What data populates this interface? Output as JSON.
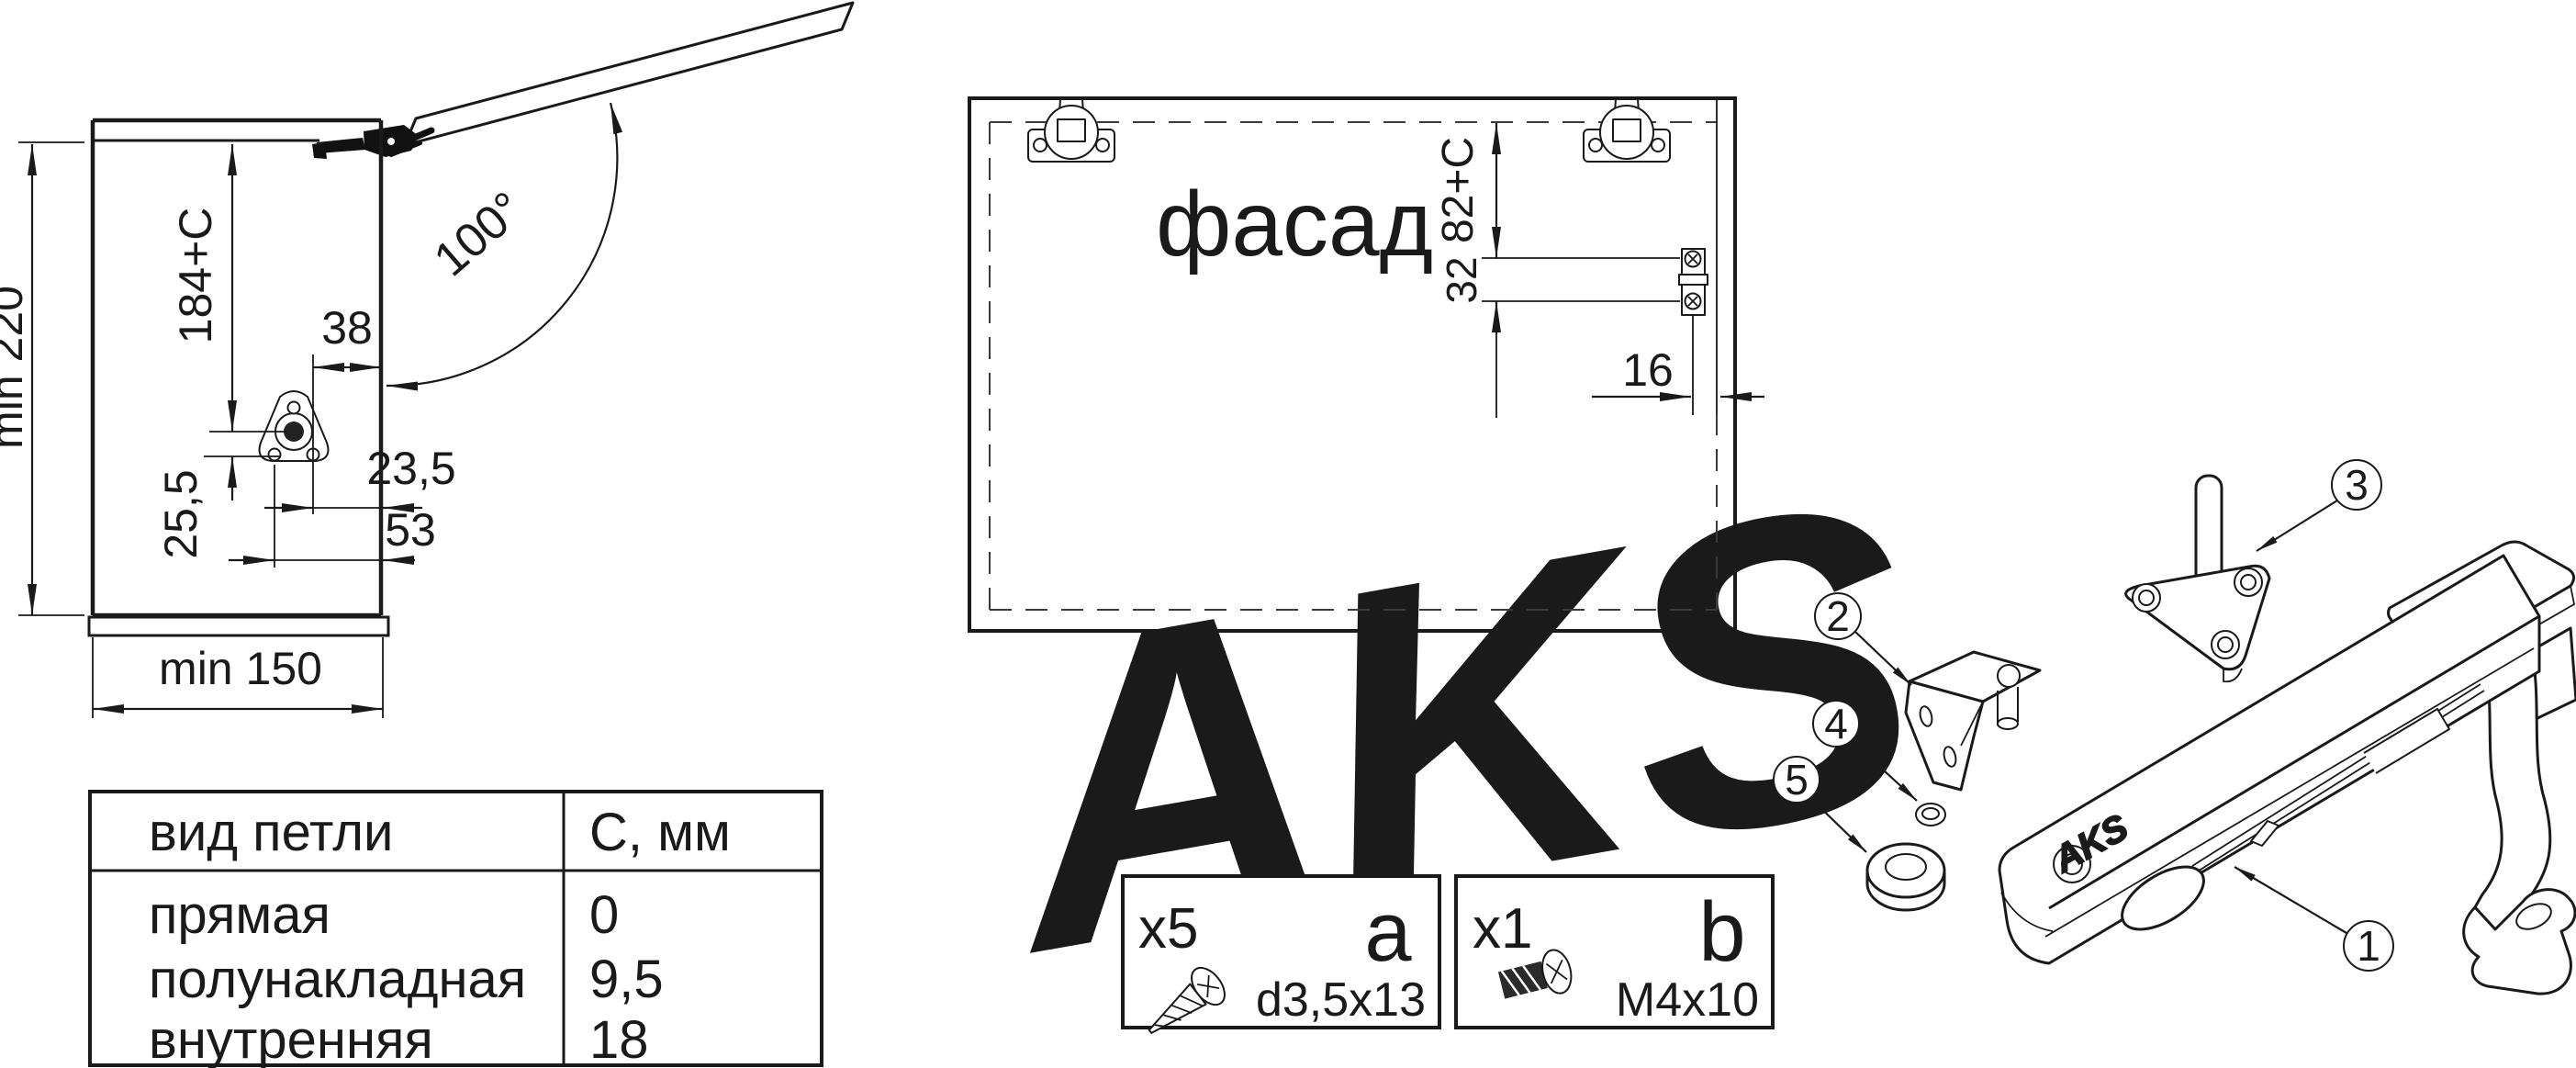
{
  "side_view": {
    "min_height": "min 220",
    "arm_height": "184+C",
    "angle": "100°",
    "dim_38": "38",
    "dim_23_5": "23,5",
    "dim_25_5": "25,5",
    "dim_53": "53",
    "min_depth": "min 150"
  },
  "hinge_table": {
    "col_type": "вид петли",
    "col_c": "С, мм",
    "rows": [
      {
        "type": "прямая",
        "c": "0"
      },
      {
        "type": "полунакладная",
        "c": "9,5"
      },
      {
        "type": "внутренняя",
        "c": "18"
      }
    ]
  },
  "facade_view": {
    "label": "фасад",
    "dim_82": "82+C",
    "dim_32": "32",
    "dim_16": "16"
  },
  "hardware_boxes": {
    "a": {
      "qty": "x5",
      "letter": "a",
      "size": "d3,5x13"
    },
    "b": {
      "qty": "x1",
      "letter": "b",
      "size": "M4x10"
    }
  },
  "exploded_view": {
    "part_1": "1",
    "part_2": "2",
    "part_3": "3",
    "part_4": "4",
    "part_5": "5",
    "brand_logo": "AKS"
  },
  "watermark": "AKS",
  "colors": {
    "line": "#1a1a1a",
    "watermark": "#ececec",
    "background": "#ffffff"
  }
}
